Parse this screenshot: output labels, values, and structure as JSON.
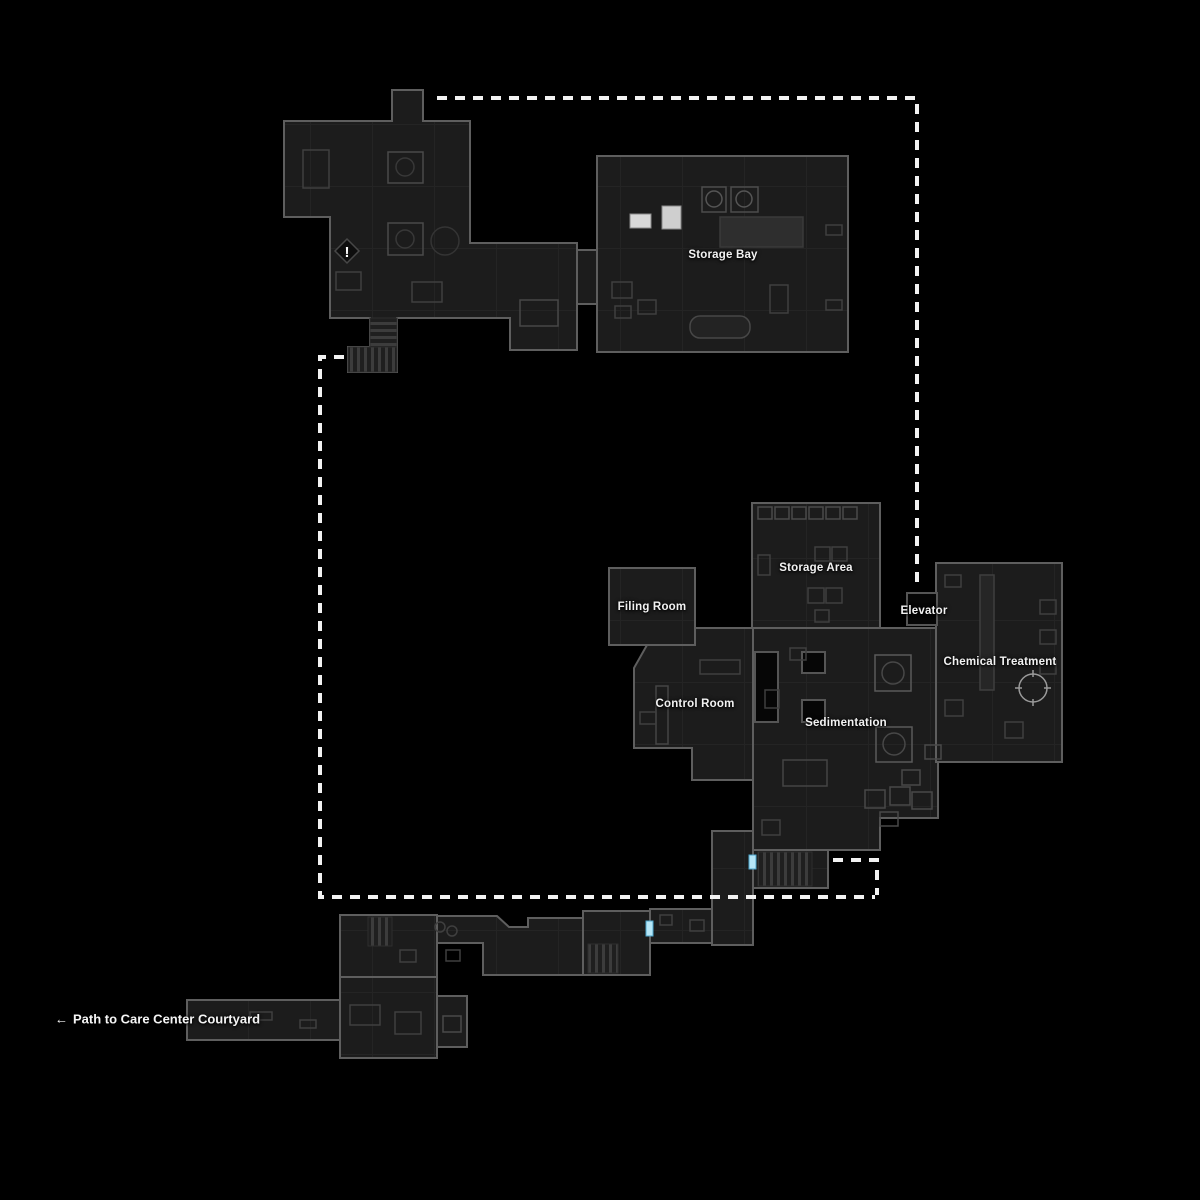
{
  "view": {
    "width": 1200,
    "height": 1200,
    "background": "#000000"
  },
  "palette": {
    "room_fill": "#1c1c1c",
    "room_border": "#5e5e5e",
    "room_grid": "#242424",
    "hole_fill": "#060606",
    "route_dash": "#f2f2f2",
    "door_marker": "#b5e6f7",
    "door_marker_edge": "#4da6cc",
    "label_text": "#f2f2f2",
    "stair_stripe": "#3c3c3c",
    "highlight_object": "#d8d8d8"
  },
  "rooms": [
    {
      "id": "storage-bay",
      "label": "Storage Bay"
    },
    {
      "id": "filing-room",
      "label": "Filing Room"
    },
    {
      "id": "storage-area",
      "label": "Storage Area"
    },
    {
      "id": "elevator",
      "label": "Elevator"
    },
    {
      "id": "chemical-treatment",
      "label": "Chemical Treatment"
    },
    {
      "id": "control-room",
      "label": "Control Room"
    },
    {
      "id": "sedimentation",
      "label": "Sedimentation"
    }
  ],
  "exit_path": {
    "arrow": "←",
    "label": "Path to Care Center Courtyard"
  },
  "markers": {
    "objective_glyph": "!",
    "door_marker_count": 2
  },
  "routes": {
    "style": "dashed",
    "color": "#f2f2f2",
    "count": 3
  }
}
